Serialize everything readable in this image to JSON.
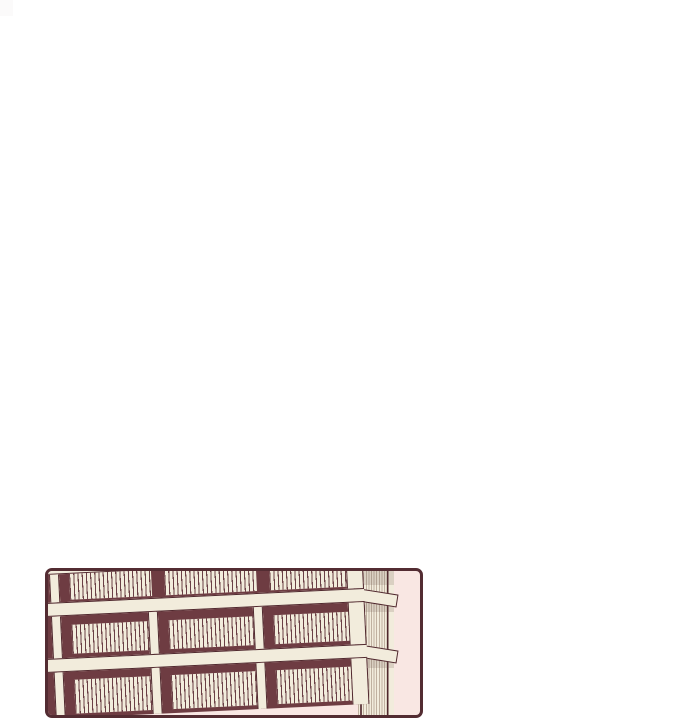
{
  "illustration": {
    "type": "webtoon-comic-panel",
    "description": "Cropped comic panel at the bottom left of an otherwise blank white page. The panel shows the upper floors of a cream and maroon apartment building with balcony railings, drawn in slight perspective, its right corner facade hatched, against a pale pink background. The panel is cut off by the bottom edge of the screenshot."
  },
  "page": {
    "background": "#ffffff",
    "width": 700,
    "height": 681
  },
  "corner_artifact": {
    "x": 0,
    "y": 0,
    "width": 13,
    "height": 16,
    "color": "#fbfafa"
  },
  "panel": {
    "x": 45,
    "y": 568,
    "width": 378,
    "height": 150,
    "border_color": "#532c32",
    "border_width": 3,
    "corner_radius": 7,
    "background": "#f9e7e3"
  },
  "building": {
    "colors": {
      "maroon": "#6e3c42",
      "cream": "#f2ecdc",
      "outline": "#4f272d",
      "railing_line": "#6a3f45",
      "hatch_line": "rgba(150,128,111,0.55)",
      "smudge": "rgba(110,85,78,0.18)"
    },
    "front": {
      "left": -8,
      "top": -25,
      "width": 322,
      "tilt_deg": -2.7,
      "rows": [
        {
          "kind": "slab",
          "h": 14
        },
        {
          "kind": "story",
          "h": 28,
          "railing_top": 0,
          "railing_bottom": 2,
          "posts": [
            [
              8,
              18
            ],
            [
              305,
              322
            ]
          ],
          "bays": [
            [
              28,
              110
            ],
            [
              123,
              215
            ],
            [
              228,
              305
            ]
          ]
        },
        {
          "kind": "slab",
          "h": 14
        },
        {
          "kind": "story",
          "h": 42,
          "railing_top": 9,
          "railing_bottom": 4,
          "posts": [
            [
              8,
              18
            ],
            [
              105,
              115
            ],
            [
              210,
              220
            ],
            [
              305,
              322
            ]
          ],
          "bays": [
            [
              28,
              105
            ],
            [
              125,
              210
            ],
            [
              230,
              305
            ]
          ]
        },
        {
          "kind": "slab",
          "h": 14
        },
        {
          "kind": "story",
          "h": 46,
          "railing_top": 8,
          "railing_bottom": 4,
          "posts": [
            [
              8,
              18
            ],
            [
              105,
              115
            ],
            [
              210,
              220
            ],
            [
              305,
              322
            ]
          ],
          "bays": [
            [
              28,
              105
            ],
            [
              125,
              210
            ],
            [
              230,
              305
            ]
          ]
        }
      ]
    },
    "side": {
      "left": 310,
      "top": -6,
      "width": 36,
      "height": 160,
      "edge_strip": {
        "left": 29,
        "width": 7
      },
      "smudges": [
        {
          "top": 6,
          "h": 14
        },
        {
          "top": 38,
          "h": 9
        },
        {
          "top": 94,
          "h": 9
        }
      ],
      "corner_edge": {
        "left": 312,
        "width": 2
      }
    },
    "returns": {
      "left": 308,
      "width": 42,
      "h": 13,
      "tilt_deg": 9,
      "tops": [
        17,
        73
      ]
    }
  }
}
